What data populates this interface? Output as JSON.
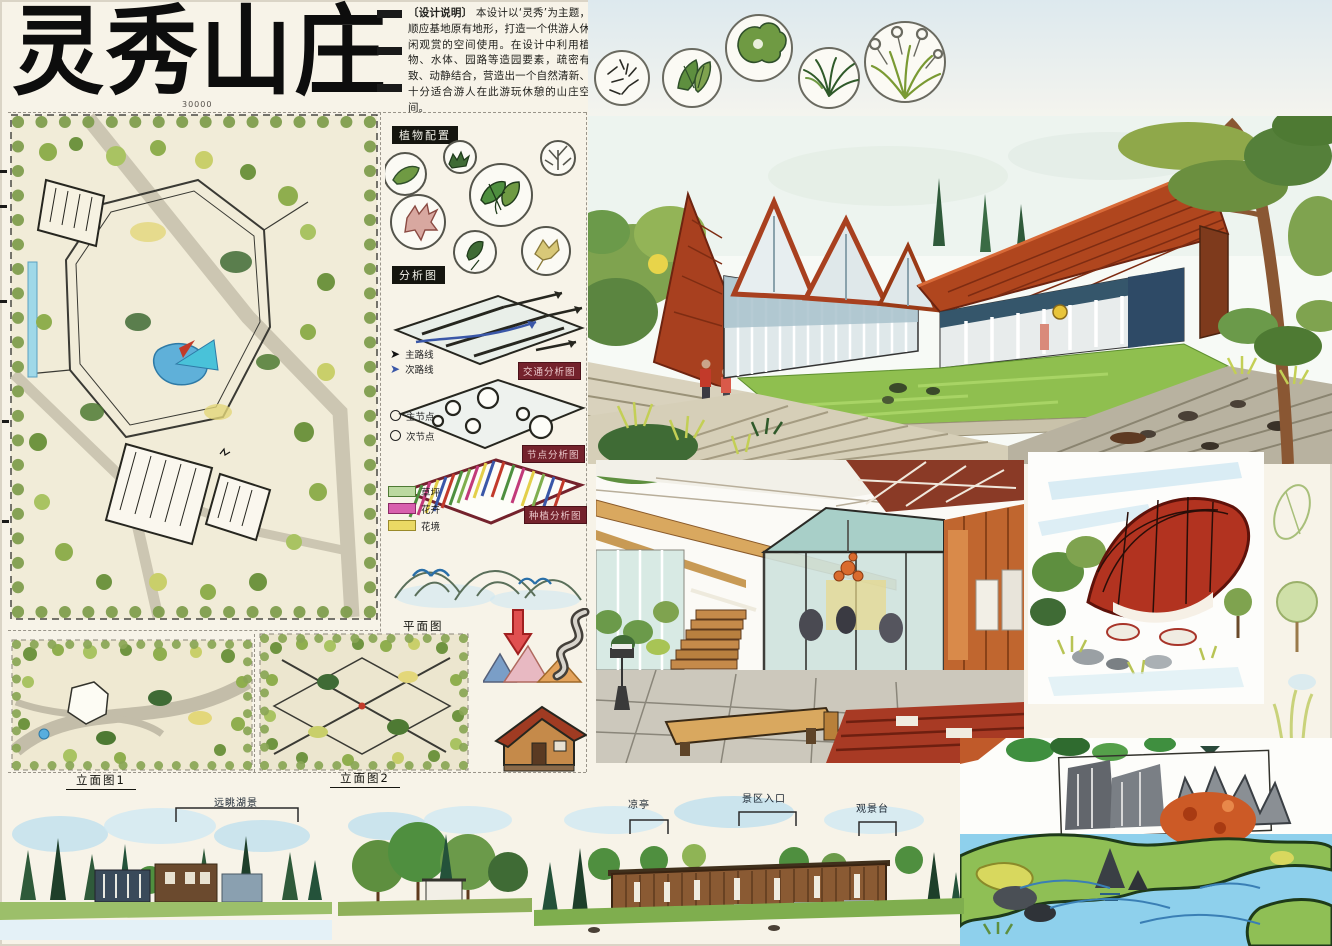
{
  "board": {
    "title": "灵秀山庄",
    "notes": {
      "heading": "〔设计说明〕",
      "body": "本设计以‘灵秀’为主题，顺应基地原有地形，打造一个供游人休闲观赏的空间使用。在设计中利用植物、水体、园路等造园要素，疏密有致、动静结合，营造出一个自然清新、十分适合游人在此游玩休憩的山庄空间。"
    },
    "labels": {
      "plant_config": "植物配置",
      "analysis": "分析图",
      "traffic": "交通分析图",
      "nodes": "节点分析图",
      "planting": "种植分析图",
      "plan": "平面图",
      "elevation1": "立面图1",
      "elevation2": "立面图2"
    },
    "legend": {
      "route_main": "主路线",
      "route_secondary": "次路线",
      "node_main": "主节点",
      "node_secondary": "次节点",
      "lawn": "草坪",
      "flowers": "花卉",
      "flower_border": "花境"
    },
    "callouts": {
      "lake_view": "远眺湖景",
      "pavilion": "凉亭",
      "entrance": "景区入口",
      "lookout": "观景台"
    },
    "dimensions": {
      "plan_top": "30000"
    },
    "colors": {
      "roof_red": "#b0461e",
      "lawn_green": "#8cbf4f",
      "water_blue": "#7cc4e8",
      "legend_lawn": "#bcd9a0",
      "legend_flowers": "#d85fae",
      "legend_border": "#ead964",
      "ink": "#141414"
    }
  }
}
